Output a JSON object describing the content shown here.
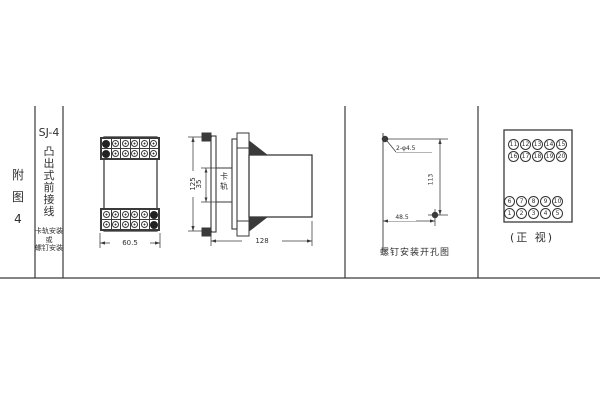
{
  "title_block": {
    "figure_label": "附图4",
    "model": "SJ-4",
    "type_label": "凸出式前接线",
    "mount_line1": "卡轨安装",
    "mount_line2": "或",
    "mount_line3": "螺钉安装"
  },
  "front_view": {
    "dim_width": "60.5"
  },
  "side_view": {
    "dim_height": "125",
    "dim_rail": "35",
    "rail_label": "卡轨",
    "dim_depth": "128"
  },
  "hole_diagram": {
    "hole_note": "2-φ4.5",
    "dim_vertical": "113",
    "dim_horizontal": "48.5",
    "caption": "螺钉安装开孔图"
  },
  "terminal_view": {
    "caption": "(正 视)",
    "top_rows": [
      [
        "11",
        "12",
        "13",
        "14",
        "15"
      ],
      [
        "16",
        "17",
        "18",
        "19",
        "20"
      ]
    ],
    "bottom_rows": [
      [
        "6",
        "7",
        "8",
        "9",
        "10"
      ],
      [
        "1",
        "2",
        "3",
        "4",
        "5"
      ]
    ]
  },
  "colors": {
    "line": "#3a3a3a",
    "fill_dark": "#3a3a3a",
    "background": "#ffffff"
  }
}
